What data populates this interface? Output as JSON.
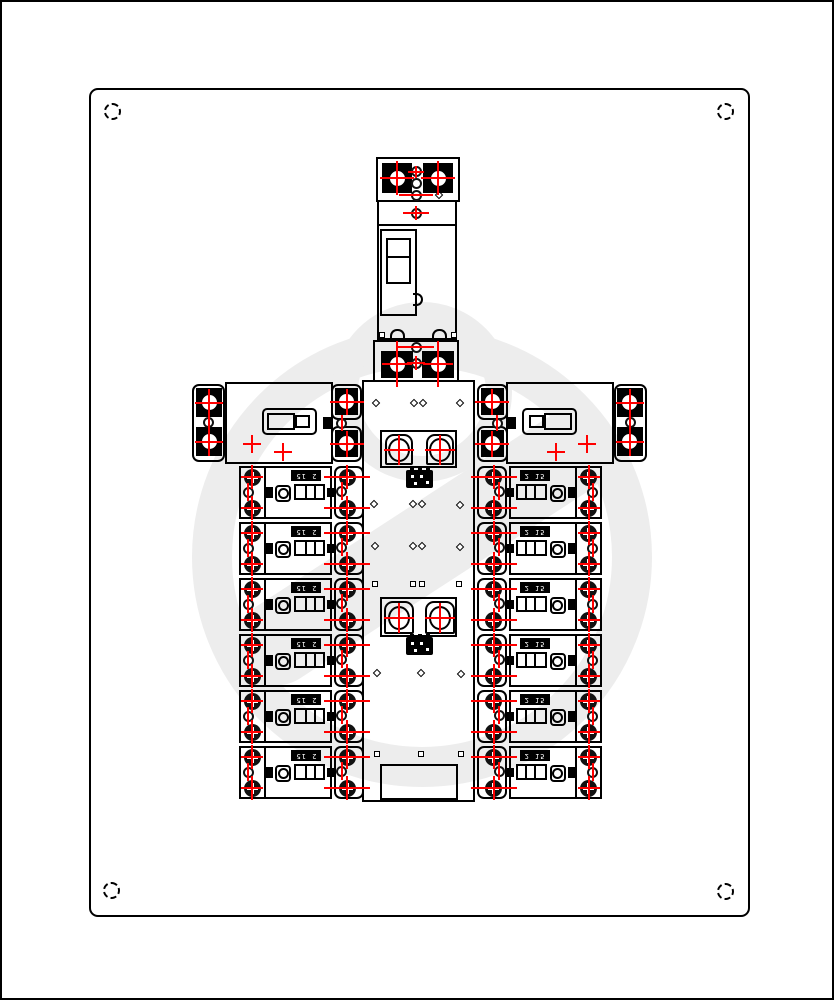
{
  "colors": {
    "line": "#000000",
    "marker_red": "#ff0000",
    "watermark_gray": "#ededed",
    "background": "#ffffff"
  },
  "enclosure": {
    "mounting_hole_count": 4
  },
  "main_breaker": {
    "pole_count": 2
  },
  "branch_breakers": {
    "count_per_side": 6,
    "left_labels": [
      "2 15",
      "2 15",
      "2 15",
      "2 15",
      "2 15",
      "2 15"
    ],
    "right_labels": [
      "2 15",
      "2 15",
      "2 15",
      "2 15",
      "2 15",
      "2 15"
    ]
  }
}
